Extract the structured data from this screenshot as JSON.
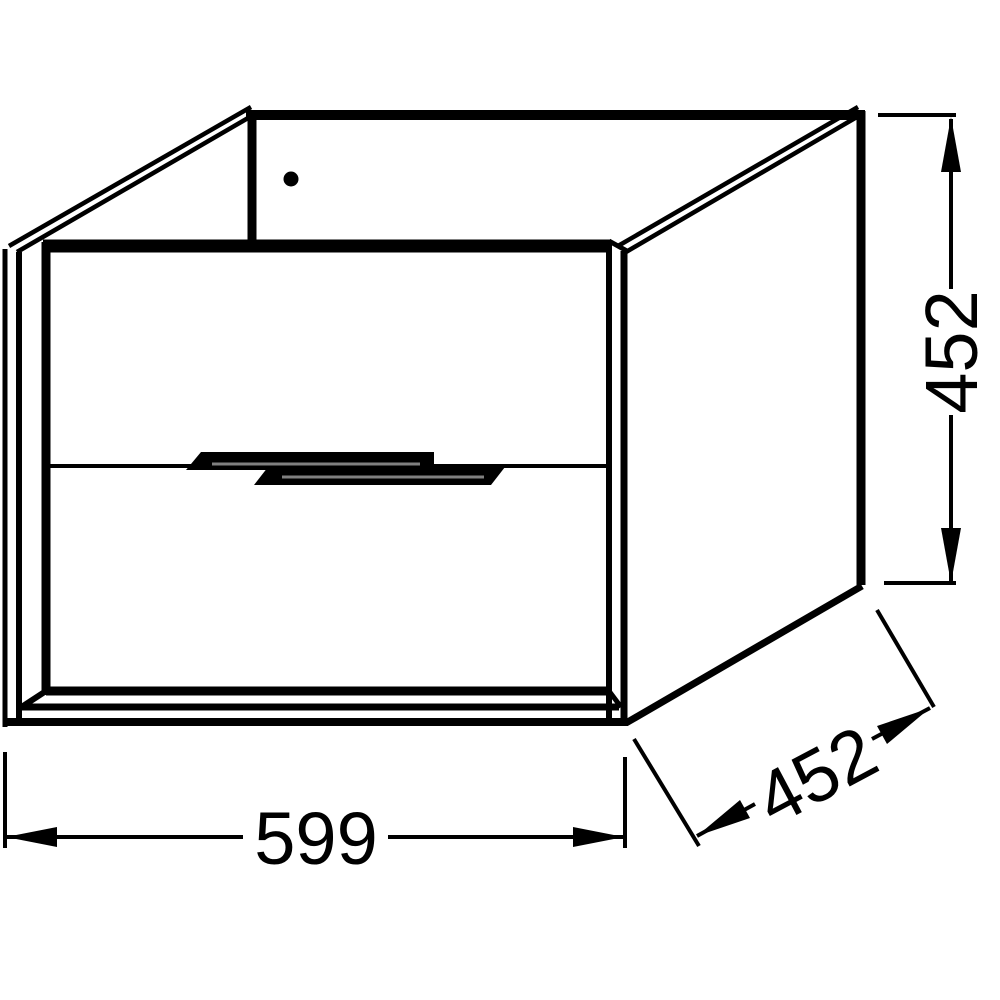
{
  "drawing": {
    "background_color": "#ffffff",
    "line_color": "#000000",
    "handle_highlight_color": "#808080",
    "dimensions": {
      "width": {
        "value": "599"
      },
      "height": {
        "value": "452"
      },
      "depth": {
        "value": "452"
      }
    }
  }
}
